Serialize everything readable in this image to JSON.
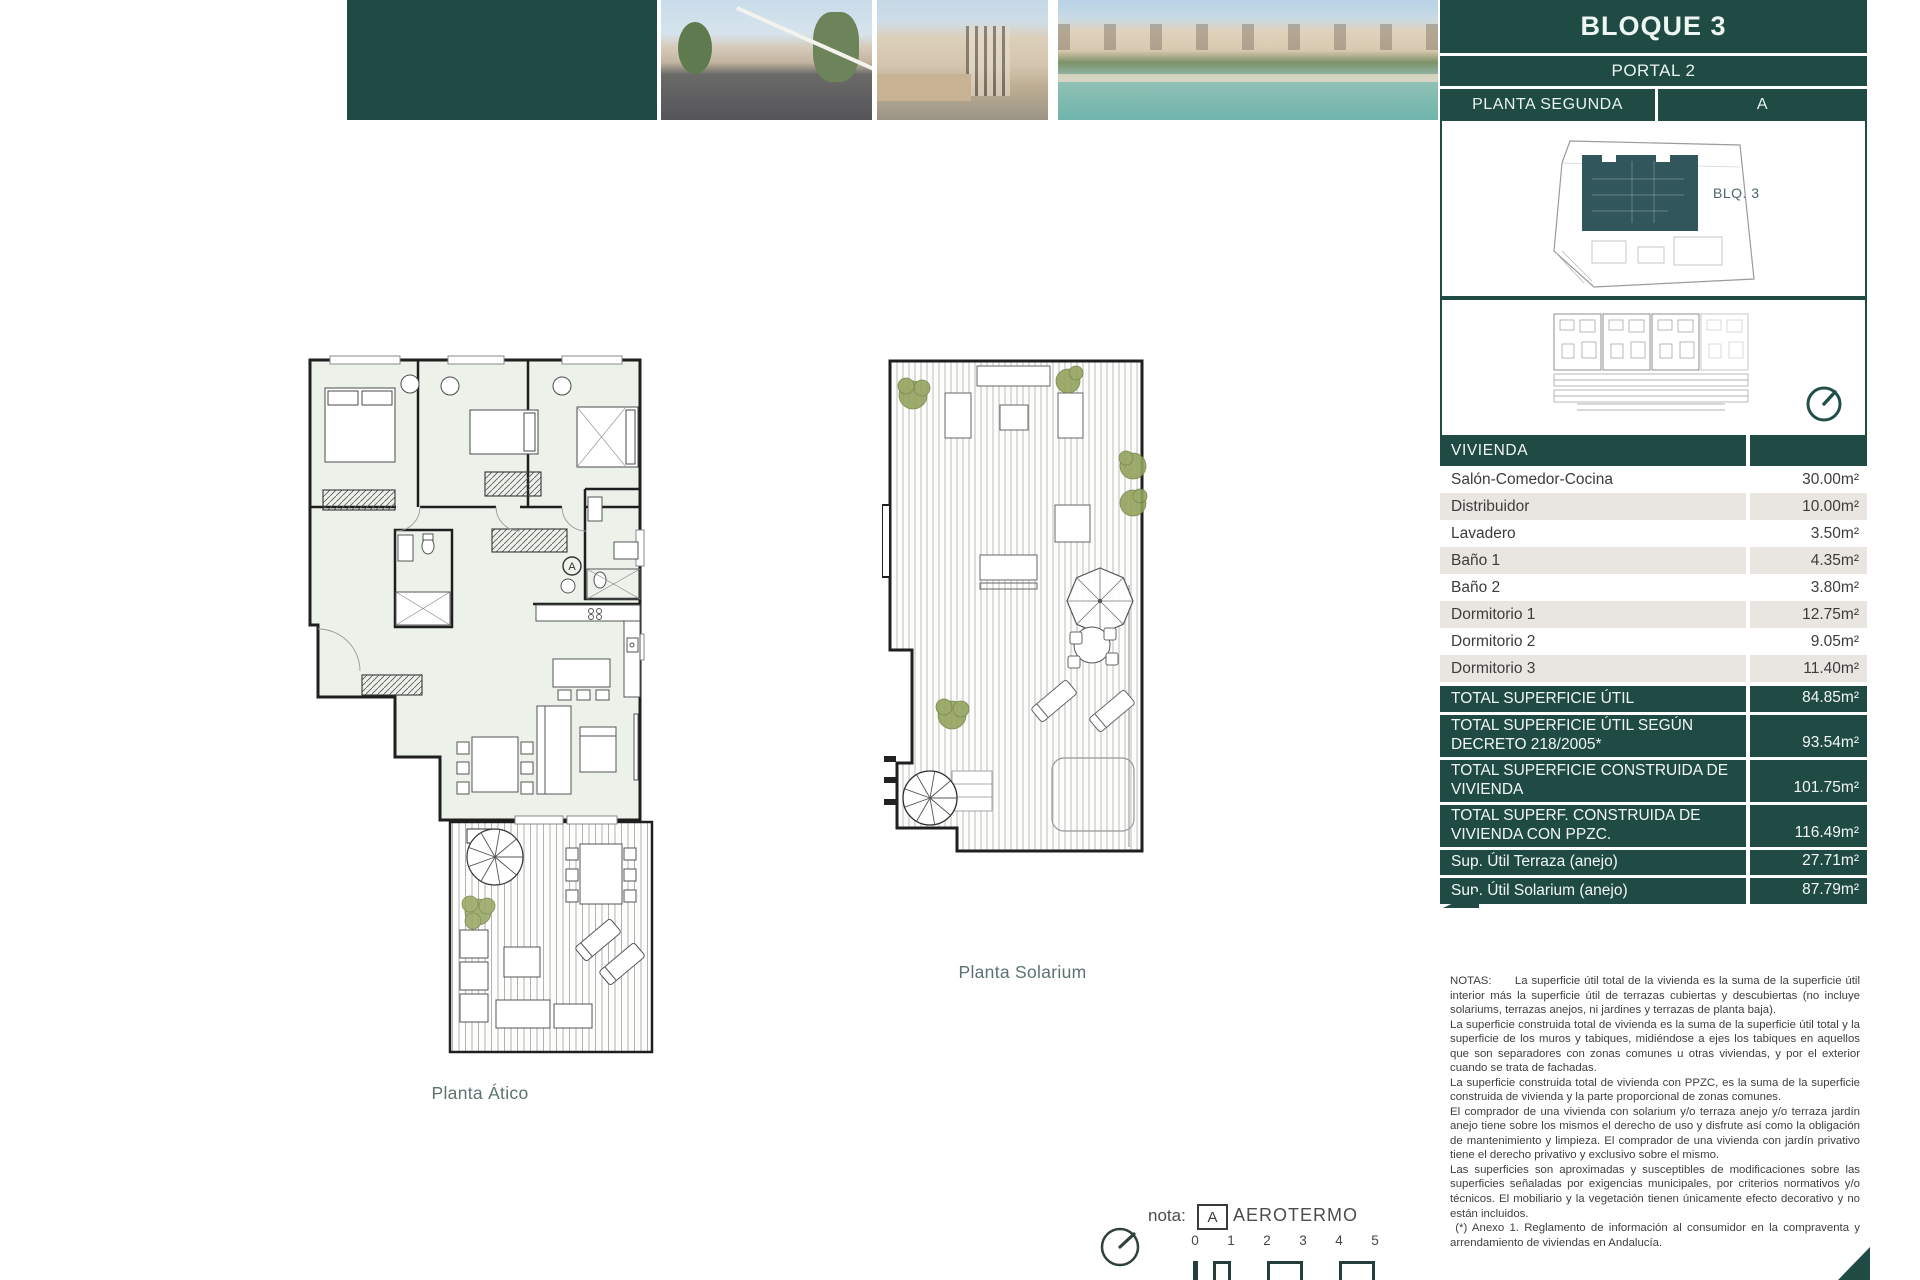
{
  "header": {
    "title": "BLOQUE 3",
    "portal": "PORTAL 2",
    "floor": "PLANTA SEGUNDA",
    "unit": "A",
    "block_label": "BLQ. 3"
  },
  "table": {
    "header": "VIVIENDA",
    "rows": [
      {
        "label": "Salón-Comedor-Cocina",
        "value": "30.00m²"
      },
      {
        "label": "Distribuidor",
        "value": "10.00m²"
      },
      {
        "label": "Lavadero",
        "value": "3.50m²"
      },
      {
        "label": "Baño 1",
        "value": "4.35m²"
      },
      {
        "label": "Baño 2",
        "value": "3.80m²"
      },
      {
        "label": "Dormitorio 1",
        "value": "12.75m²"
      },
      {
        "label": "Dormitorio 2",
        "value": "9.05m²"
      },
      {
        "label": "Dormitorio 3",
        "value": "11.40m²"
      }
    ],
    "totals": [
      {
        "label": "TOTAL SUPERFICIE ÚTIL",
        "value": "84.85m²"
      },
      {
        "label": "TOTAL SUPERFICIE ÚTIL SEGÚN DECRETO 218/2005*",
        "value": "93.54m²"
      },
      {
        "label": "TOTAL SUPERFICIE CONSTRUIDA DE VIVIENDA",
        "value": "101.75m²"
      },
      {
        "label": "TOTAL SUPERF. CONSTRUIDA DE VIVIENDA CON PPZC.",
        "value": "116.49m²"
      },
      {
        "label": "Sup. Útil Terraza (anejo)",
        "value": "27.71m²"
      },
      {
        "label": "Sup. Útil Solarium (anejo)",
        "value": "87.79m²"
      }
    ]
  },
  "plans": {
    "atico_label": "Planta Ático",
    "solarium_label": "Planta Solarium",
    "aerotermo_mark": "A"
  },
  "legend": {
    "nota_label": "nota:",
    "aerotermo_box": "A",
    "aerotermo_text": "AEROTERMO"
  },
  "scale": {
    "ticks": [
      "0",
      "1",
      "2",
      "3",
      "4",
      "5"
    ]
  },
  "notes": {
    "paragraphs": [
      "NOTAS:      La superficie útil total de la vivienda es la suma de la superficie útil interior más la superficie útil de terrazas cubiertas y descubiertas (no incluye solariums, terrazas anejos, ni jardines y terrazas de planta baja).",
      "La superficie construida total de vivienda es la suma de la superficie útil total y la superficie de los muros y tabiques, midiéndose a ejes los tabiques en aquellos que son separadores con zonas comunes u otras viviendas, y por el exterior cuando se trata de fachadas.",
      "La superficie construida total de vivienda con PPZC, es la suma de la superficie construida de vivienda y la parte proporcional de zonas comunes.",
      "El comprador de una vivienda con solarium y/o terraza anejo y/o terraza jardín anejo tiene sobre los mismos el derecho de uso y disfrute así como la obligación de mantenimiento y limpieza. El comprador de una vivienda con jardín privativo tiene el derecho privativo y exclusivo sobre el mismo.",
      "Las superficies son aproximadas y susceptibles de modificaciones sobre las superficies señaladas por exigencias municipales, por criterios normativos y/o técnicos. El mobiliario y la vegetación tienen únicamente efecto decorativo y no están incluidos.",
      " (*) Anexo 1. Reglamento de información al consumidor en la compraventa y arrendamiento de viviendas en Andalucía."
    ]
  },
  "colors": {
    "accent_teal": "#204b45",
    "row_alt": "#e9e6e2",
    "site_building": "#31575c",
    "room_fill": "#ecf2ea"
  }
}
